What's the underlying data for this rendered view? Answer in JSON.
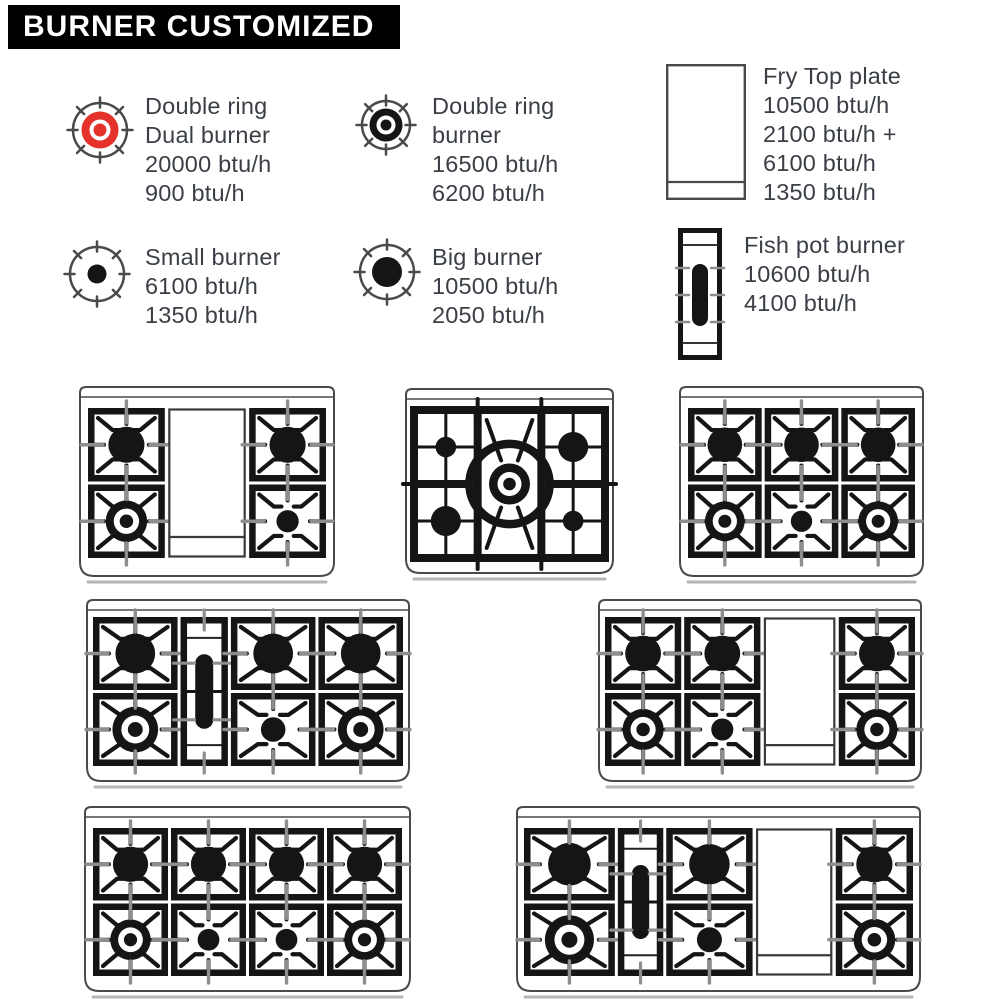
{
  "title": "BURNER CUSTOMIZED",
  "colors": {
    "red": "#e5332c",
    "ink": "#151515",
    "text": "#3a3f46",
    "outline": "#4a4a4a",
    "tick": "#8e8e8e"
  },
  "legend": [
    {
      "id": "double-ring-dual-burner",
      "icon": "dual-ring-red-icon",
      "lines": [
        "Double ring",
        "Dual burner",
        "20000 btu/h",
        "900 btu/h"
      ]
    },
    {
      "id": "double-ring-burner",
      "icon": "double-ring-icon",
      "lines": [
        "Double ring",
        "burner",
        "16500 btu/h",
        "6200 btu/h"
      ]
    },
    {
      "id": "fry-top-plate",
      "icon": "fry-top-icon",
      "lines": [
        "Fry Top plate",
        "10500 btu/h",
        "2100 btu/h +",
        "6100 btu/h",
        "1350 btu/h"
      ]
    },
    {
      "id": "small-burner",
      "icon": "small-burner-icon",
      "lines": [
        "Small burner",
        "6100 btu/h",
        "1350 btu/h"
      ]
    },
    {
      "id": "big-burner",
      "icon": "big-burner-icon",
      "lines": [
        "Big burner",
        "10500 btu/h",
        "2050 btu/h"
      ]
    },
    {
      "id": "fish-pot-burner",
      "icon": "fish-pot-icon",
      "lines": [
        "Fish pot burner",
        "10600 btu/h",
        "4100 btu/h"
      ]
    }
  ],
  "cooktops": [
    {
      "name": "cooktop-4-burner-fry-top",
      "columns": [
        {
          "cells": [
            "big",
            "ring"
          ]
        },
        {
          "plate": "frytop"
        },
        {
          "cells": [
            "big",
            "small"
          ]
        }
      ]
    },
    {
      "name": "cooktop-5-burner-dual-center",
      "style": "dual",
      "columns": [
        {
          "cells": [
            "small",
            "big"
          ]
        },
        {
          "plate": "dual-center"
        },
        {
          "cells": [
            "big",
            "small"
          ]
        }
      ]
    },
    {
      "name": "cooktop-6-burner",
      "columns": [
        {
          "cells": [
            "big",
            "ring"
          ]
        },
        {
          "cells": [
            "big",
            "small"
          ]
        },
        {
          "cells": [
            "big",
            "ring"
          ]
        }
      ]
    },
    {
      "name": "cooktop-8-burner-fish-pot",
      "columns": [
        {
          "cells": [
            "big",
            "ring"
          ]
        },
        {
          "plate": "fishpot"
        },
        {
          "cells": [
            "big",
            "small"
          ]
        },
        {
          "cells": [
            "big",
            "ring"
          ]
        }
      ]
    },
    {
      "name": "cooktop-6-burner-fry-top",
      "columns": [
        {
          "cells": [
            "big",
            "ring"
          ]
        },
        {
          "cells": [
            "big",
            "small"
          ]
        },
        {
          "plate": "frytop"
        },
        {
          "cells": [
            "big",
            "ring"
          ]
        }
      ]
    },
    {
      "name": "cooktop-8-burner",
      "columns": [
        {
          "cells": [
            "big",
            "ring"
          ]
        },
        {
          "cells": [
            "big",
            "small"
          ]
        },
        {
          "cells": [
            "big",
            "small"
          ]
        },
        {
          "cells": [
            "big",
            "ring"
          ]
        }
      ]
    },
    {
      "name": "cooktop-6-burner-fish-pot-fry-top",
      "columns": [
        {
          "cells": [
            "big",
            "ring"
          ]
        },
        {
          "plate": "fishpot"
        },
        {
          "cells": [
            "big",
            "small"
          ]
        },
        {
          "plate": "frytop"
        },
        {
          "cells": [
            "big",
            "ring"
          ]
        }
      ]
    }
  ]
}
